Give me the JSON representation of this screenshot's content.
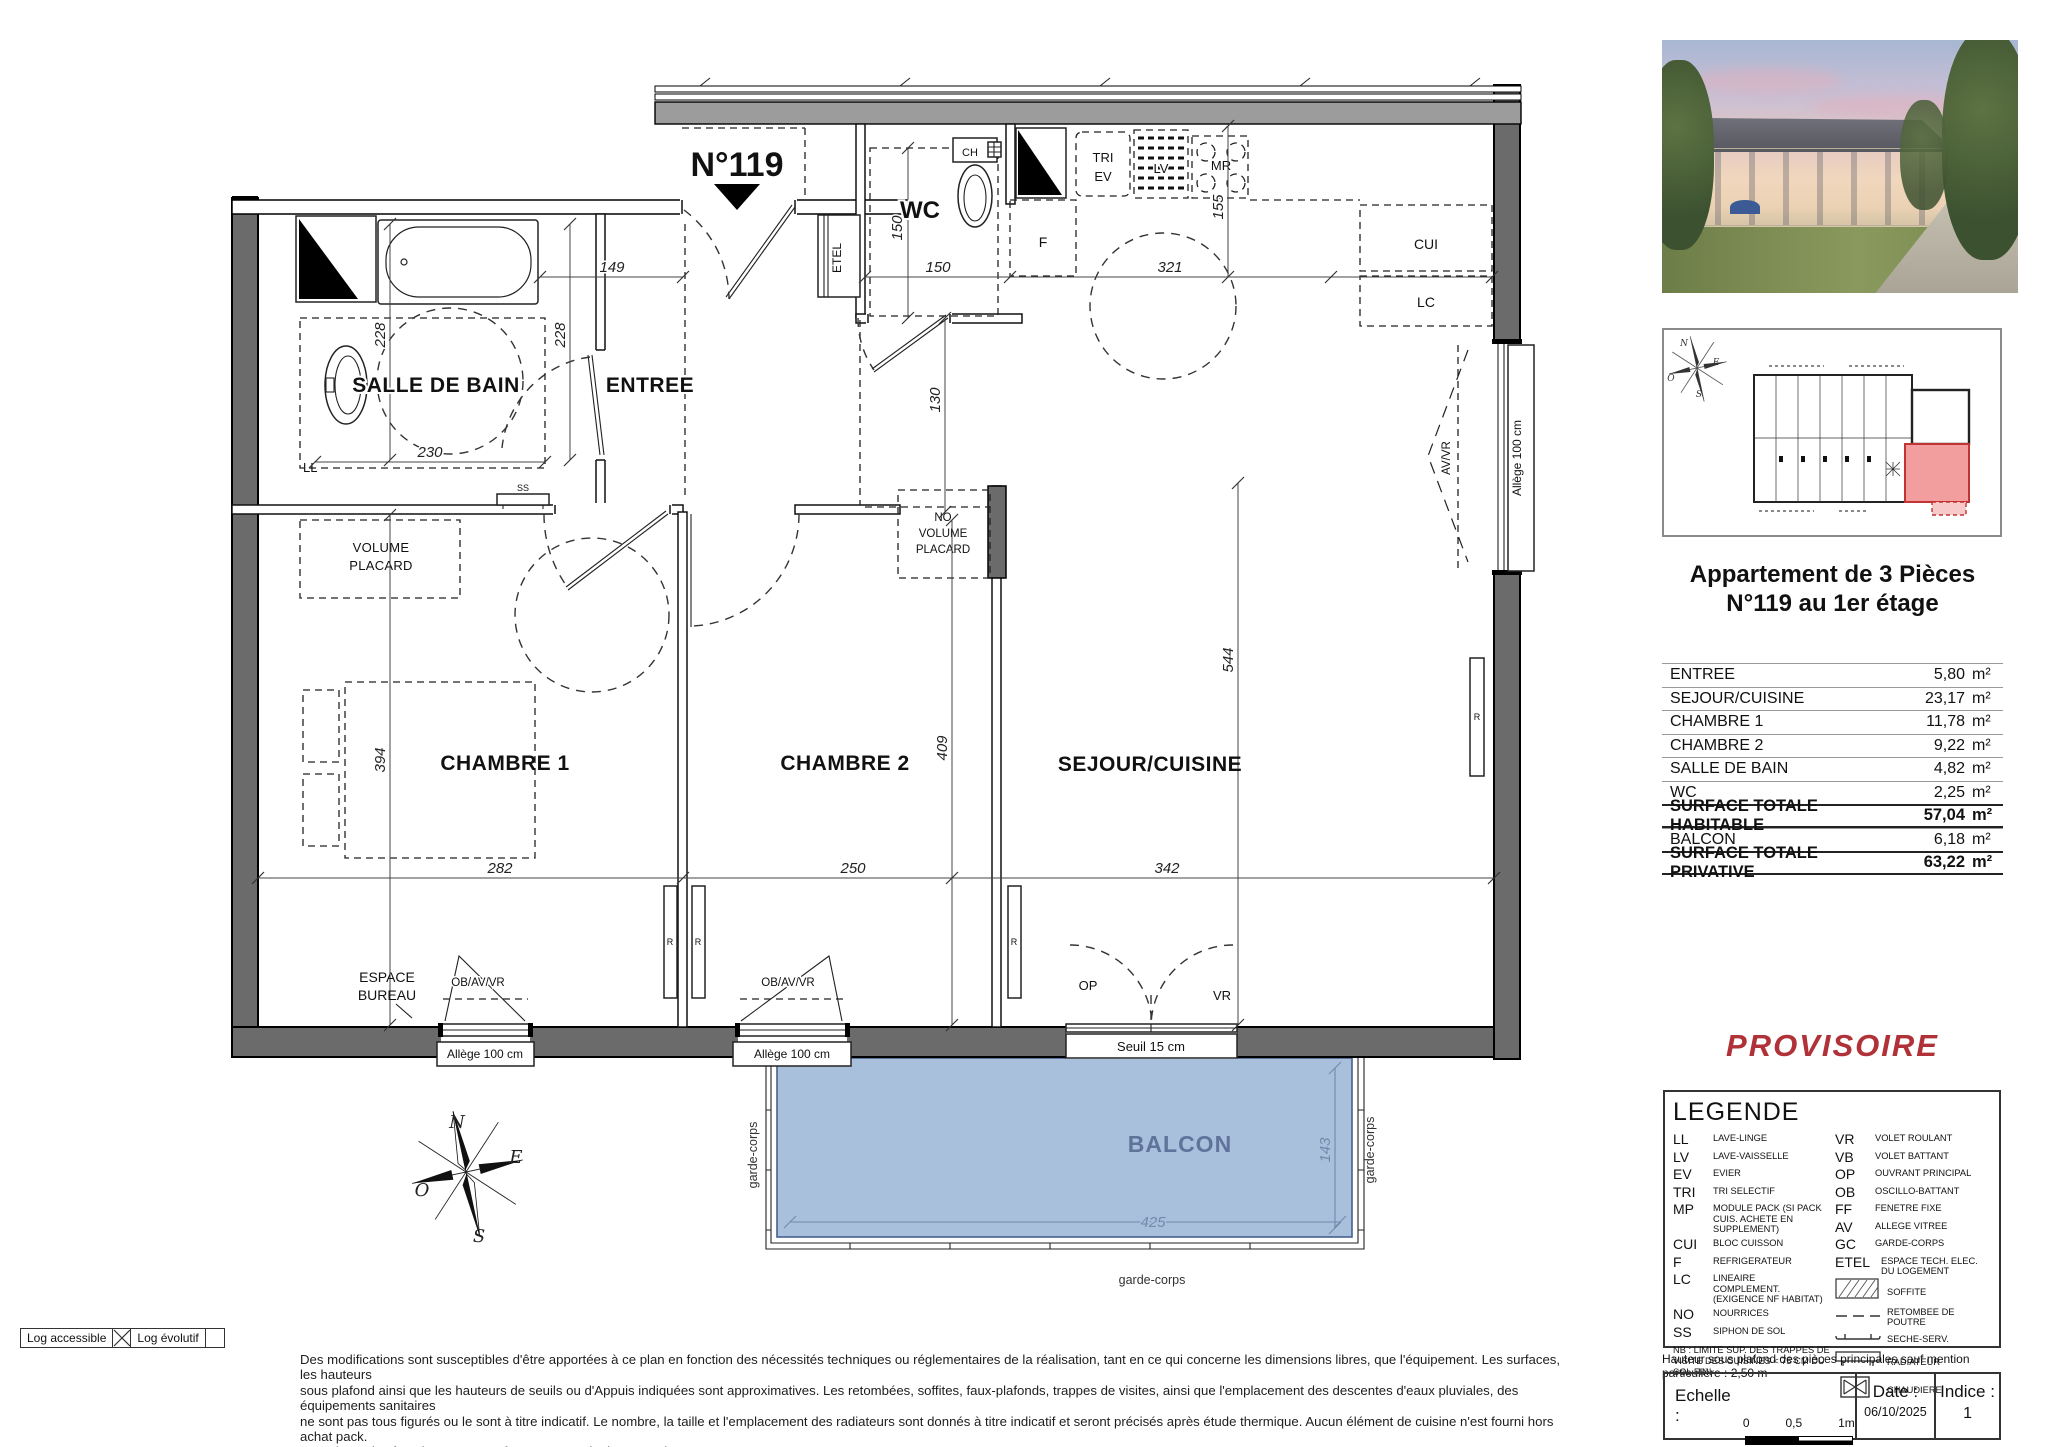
{
  "colors": {
    "wall_gray": "#6b6b6b",
    "balcony_fill": "#a9c0dc",
    "balcony_text": "#5f739b",
    "provisoire_red": "#b03238",
    "site_unit_red": "#f29e9e"
  },
  "plan": {
    "unit_number": "N°119",
    "rooms": {
      "salle_de_bain": "SALLE DE BAIN",
      "entree": "ENTREE",
      "wc": "WC",
      "chambre_1": "CHAMBRE 1",
      "chambre_2": "CHAMBRE 2",
      "sejour_cuisine": "SEJOUR/CUISINE",
      "balcon": "BALCON",
      "espace_bureau_line1": "ESPACE",
      "espace_bureau_line2": "BUREAU"
    },
    "closets": {
      "volume_line1": "VOLUME",
      "volume_line2": "PLACARD",
      "no_volume_line1": "NO",
      "no_volume_line2": "VOLUME",
      "no_volume_line3": "PLACARD"
    },
    "equipment": {
      "ll": "LL",
      "ss": "SS",
      "etel": "ETEL",
      "ch": "CH",
      "tri": "TRI",
      "ev": "EV",
      "lv": "LV",
      "mr": "MR",
      "f": "F",
      "cui": "CUI",
      "lc": "LC",
      "r": "R"
    },
    "dims": {
      "d149": "149",
      "d150_wc_w": "150",
      "d150_wc_h": "150",
      "d130": "130",
      "d228_a": "228",
      "d228_b": "228",
      "d230": "230",
      "d321": "321",
      "d155": "155",
      "d544": "544",
      "d409": "409",
      "d394": "394",
      "d282": "282",
      "d250": "250",
      "d342": "342",
      "d425": "425",
      "d143": "143"
    },
    "openings": {
      "ob_av_vr": "OB/AV/VR",
      "av_vr": "AV/VR",
      "allege_100": "Allège 100 cm",
      "seuil_15": "Seuil 15 cm",
      "op": "OP",
      "vr": "VR",
      "garde_corps": "garde-corps"
    },
    "compass": {
      "n": "N",
      "e": "E",
      "s": "S",
      "o": "O"
    }
  },
  "sidebar": {
    "title_line1": "Appartement de 3 Pièces",
    "title_line2": "N°119 au 1er étage",
    "surface_table": {
      "rows": [
        {
          "label": "ENTREE",
          "value": "5,80",
          "unit": "m²"
        },
        {
          "label": "SEJOUR/CUISINE",
          "value": "23,17",
          "unit": "m²"
        },
        {
          "label": "CHAMBRE 1",
          "value": "11,78",
          "unit": "m²"
        },
        {
          "label": "CHAMBRE 2",
          "value": "9,22",
          "unit": "m²"
        },
        {
          "label": "SALLE DE BAIN",
          "value": "4,82",
          "unit": "m²"
        },
        {
          "label": "WC",
          "value": "2,25",
          "unit": "m²"
        },
        {
          "label": "SURFACE TOTALE HABITABLE",
          "value": "57,04",
          "unit": "m²"
        },
        {
          "label": "BALCON",
          "value": "6,18",
          "unit": "m²"
        },
        {
          "label": "SURFACE TOTALE PRIVATIVE",
          "value": "63,22",
          "unit": "m²"
        }
      ]
    },
    "provisoire": "PROVISOIRE"
  },
  "legend": {
    "title": "LEGENDE",
    "left": [
      {
        "abbr": "LL",
        "label": "LAVE-LINGE"
      },
      {
        "abbr": "LV",
        "label": "LAVE-VAISSELLE"
      },
      {
        "abbr": "EV",
        "label": "EVIER"
      },
      {
        "abbr": "TRI",
        "label": "TRI SELECTIF"
      },
      {
        "abbr": "MP",
        "label": "MODULE PACK (SI PACK CUIS. ACHETE EN SUPPLEMENT)"
      },
      {
        "abbr": "CUI",
        "label": "BLOC CUISSON"
      },
      {
        "abbr": "F",
        "label": "REFRIGERATEUR"
      },
      {
        "abbr": "LC",
        "label": "LINEAIRE COMPLEMENT. (EXIGENCE NF HABITAT)"
      },
      {
        "abbr": "NO",
        "label": "NOURRICES"
      },
      {
        "abbr": "SS",
        "label": "SIPHON DE SOL"
      }
    ],
    "right": [
      {
        "abbr": "VR",
        "label": "VOLET ROULANT"
      },
      {
        "abbr": "VB",
        "label": "VOLET BATTANT"
      },
      {
        "abbr": "OP",
        "label": "OUVRANT PRINCIPAL"
      },
      {
        "abbr": "OB",
        "label": "OSCILLO-BATTANT"
      },
      {
        "abbr": "FF",
        "label": "FENETRE FIXE"
      },
      {
        "abbr": "AV",
        "label": "ALLEGE VITREE"
      },
      {
        "abbr": "GC",
        "label": "GARDE-CORPS"
      },
      {
        "abbr": "ETEL",
        "label": "ESPACE TECH. ELEC. DU LOGEMENT"
      }
    ],
    "symbols": [
      {
        "icon": "soffite-swatch",
        "label": "SOFFITE"
      },
      {
        "icon": "retombee-line",
        "label": "RETOMBEE DE POUTRE"
      },
      {
        "icon": "seche-serviette-symbol",
        "label": "SECHE-SERV."
      },
      {
        "icon": "radiateur-symbol",
        "label": "RADIATEUR"
      },
      {
        "icon": "chaudiere-symbol",
        "label": "CHAUDIERE"
      }
    ],
    "note": "NB : LIMITE SUP. DES TRAPPES DE VISITE DES CUISINES < 75 CM DU SOL FINI"
  },
  "footer": {
    "hauteur_note": "Hauteur sous plafond des pièces principales sauf mention particulière : 2,50 m",
    "echelle_label": "Echelle :",
    "scale_tick_0": "0",
    "scale_tick_05": "0,5",
    "scale_tick_1m": "1m",
    "date_label": "Date :",
    "date_value": "06/10/2025",
    "indice_label": "Indice :",
    "indice_value": "1"
  },
  "stamp_box": {
    "log_accessible": "Log accessible",
    "log_evolutif": "Log évolutif"
  },
  "disclaimer": {
    "line1": "Des modifications sont susceptibles d'être apportées à ce plan en fonction des nécessités techniques ou réglementaires de la réalisation, tant en ce qui concerne les dimensions libres, que l'équipement. Les surfaces, les hauteurs",
    "line2": "sous plafond ainsi que les hauteurs de seuils ou d'Appuis indiquées sont approximatives. Les retombées, soffites, faux-plafonds, trappes de visites, ainsi que l'emplacement des descentes d'eaux pluviales, des équipements sanitaires",
    "line3": "ne sont pas tous figurés ou le sont à titre indicatif. Le nombre, la taille et l'emplacement des radiateurs sont donnés à titre indicatif et seront précisés après étude thermique. Aucun élément de cuisine n'est fourni hors achat pack.",
    "line4": "Les teintes des façades seront conforme au permis de construire."
  }
}
